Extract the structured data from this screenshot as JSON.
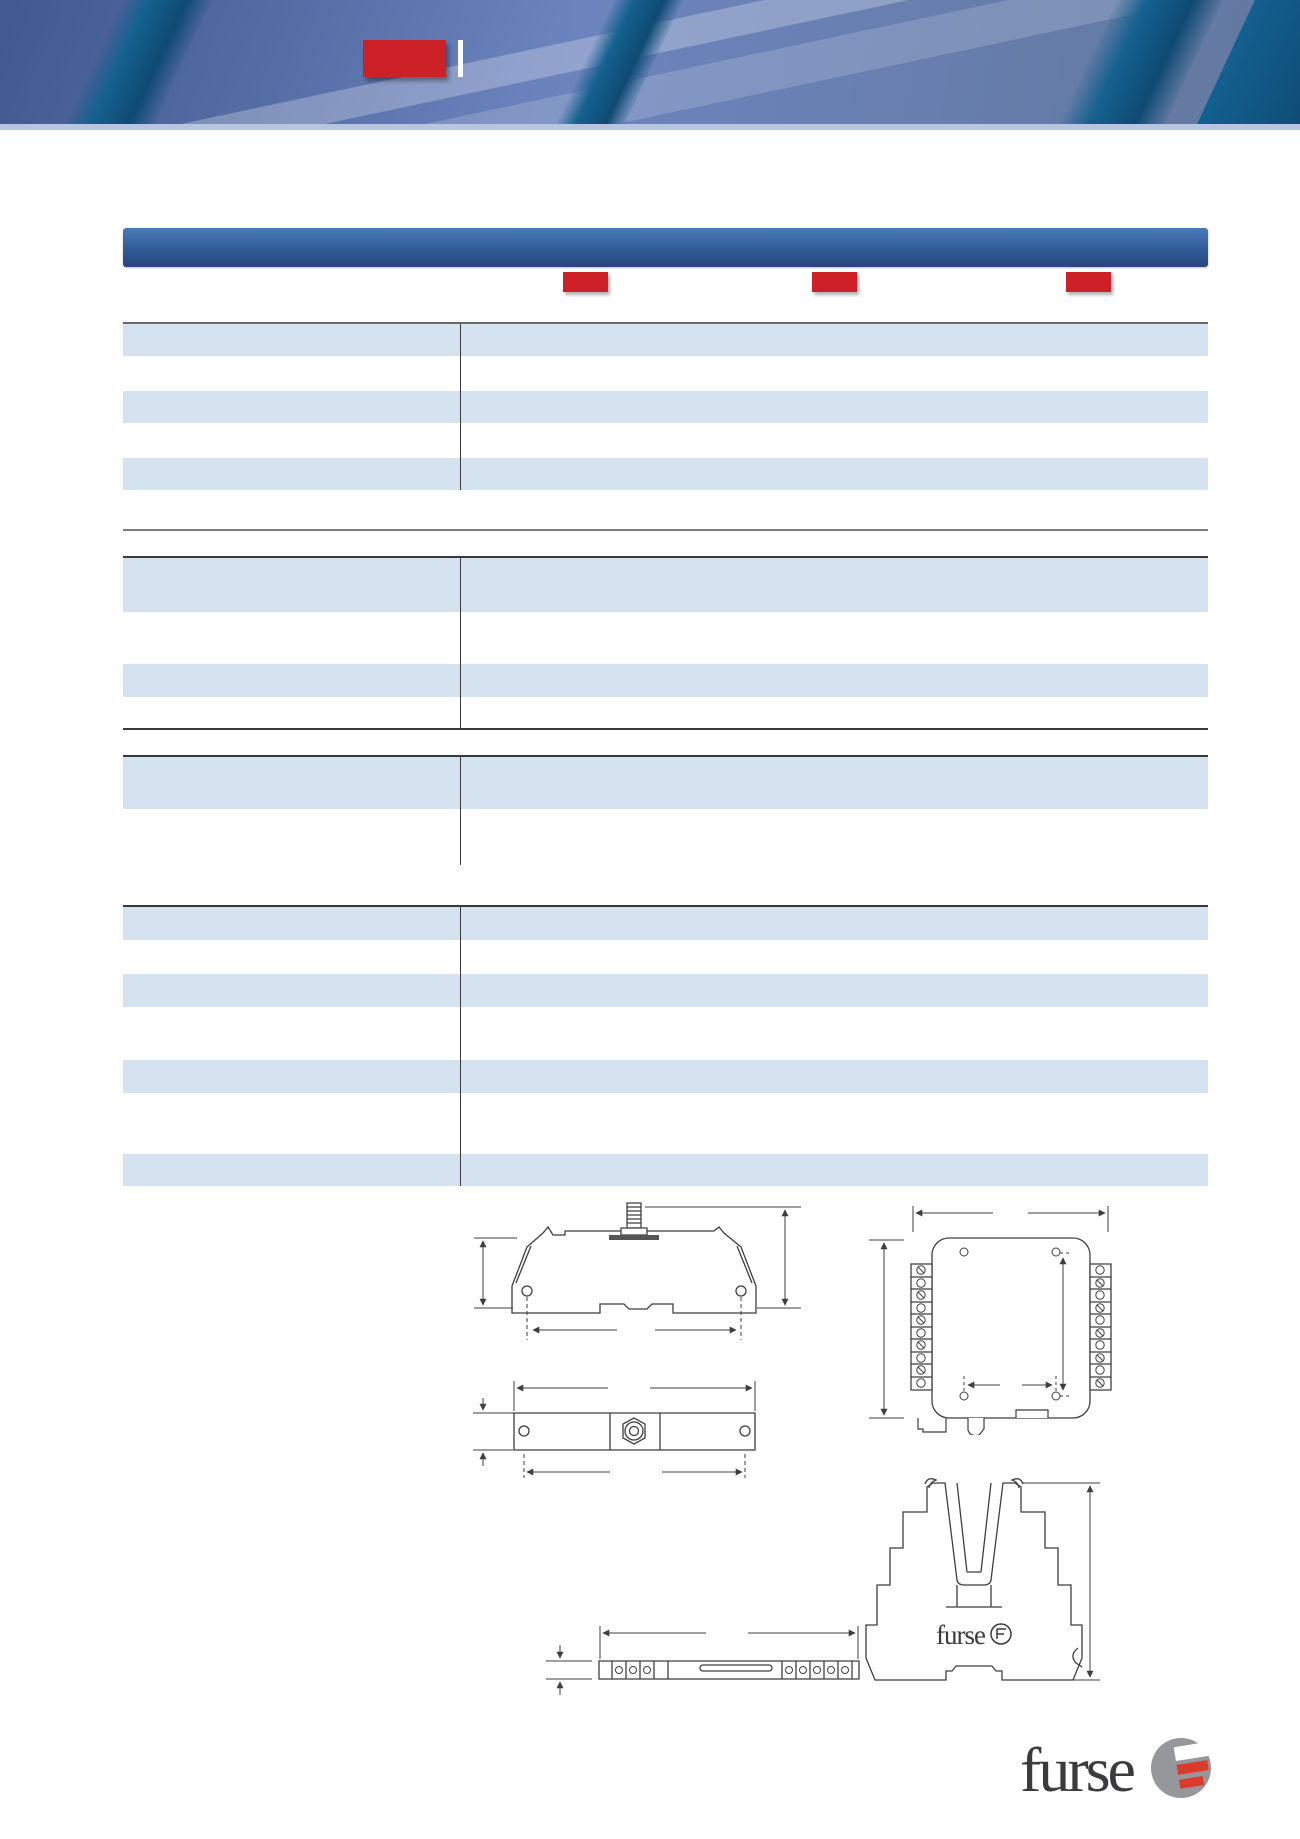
{
  "page": {
    "width": 1300,
    "height": 1839,
    "background": "#ffffff"
  },
  "header": {
    "photo": {
      "base_color": "#6c84bd",
      "rib_color": "#15618f",
      "shade_color": "#1e3264",
      "streak_color": "rgba(255,255,255,0.26)"
    },
    "rule_color": "#b7c5de",
    "product_badge": {
      "x": 363,
      "y": 40,
      "w": 83,
      "h": 37,
      "color": "#cd2027"
    },
    "title_divider_bar": {
      "x": 458,
      "y": 40,
      "w": 5,
      "h": 37,
      "color": "#ffffff"
    }
  },
  "title_bar": {
    "x": 123,
    "y": 228,
    "w": 1085,
    "h": 39,
    "color_top": "#4a7ab8",
    "color_mid": "#35619f",
    "color_bottom": "#26457c"
  },
  "column_markers": {
    "y": 272,
    "w": 45,
    "h": 20,
    "color": "#cd2027",
    "xs": [
      563,
      812,
      1066
    ]
  },
  "table": {
    "x": 123,
    "w": 1085,
    "divider_x": 337,
    "row_colors": {
      "b": "#d5e2ef",
      "w": "#ffffff"
    },
    "sections": [
      {
        "id": "section-1",
        "top": 322,
        "border_top": "#6a6a6a",
        "border_bottom": "",
        "rows": [
          [
            "b",
            32
          ],
          [
            "w",
            35
          ],
          [
            "b",
            32
          ],
          [
            "w",
            35
          ],
          [
            "b",
            32
          ]
        ]
      },
      {
        "id": "section-2",
        "top": 556,
        "border_top": "#3a3a3a",
        "border_bottom": "#3a3a3a",
        "rows": [
          [
            "b",
            54
          ],
          [
            "w",
            52
          ],
          [
            "b",
            33
          ],
          [
            "w",
            31
          ]
        ]
      },
      {
        "id": "section-3",
        "top": 755,
        "border_top": "#3a3a3a",
        "border_bottom": "",
        "rows": [
          [
            "b",
            52
          ],
          [
            "w",
            56
          ]
        ]
      },
      {
        "id": "section-4",
        "top": 905,
        "border_top": "#3a3a3a",
        "border_bottom": "",
        "rows": [
          [
            "b",
            33
          ],
          [
            "w",
            34
          ],
          [
            "b",
            33
          ],
          [
            "w",
            53
          ],
          [
            "b",
            33
          ],
          [
            "w",
            61
          ],
          [
            "b",
            32
          ]
        ]
      }
    ],
    "separator_line": {
      "x": 123,
      "y": 529,
      "w": 1085,
      "h": 2,
      "color": "#7d7d7d"
    }
  },
  "drawings": {
    "stroke_color": "#3f3f3f"
  },
  "drawing_logo": {
    "text": "furse"
  },
  "logo": {
    "text": "furse",
    "text_color": "#3b3b3d",
    "circle_color": "#96979a",
    "accent_color": "#dd3a2e"
  }
}
